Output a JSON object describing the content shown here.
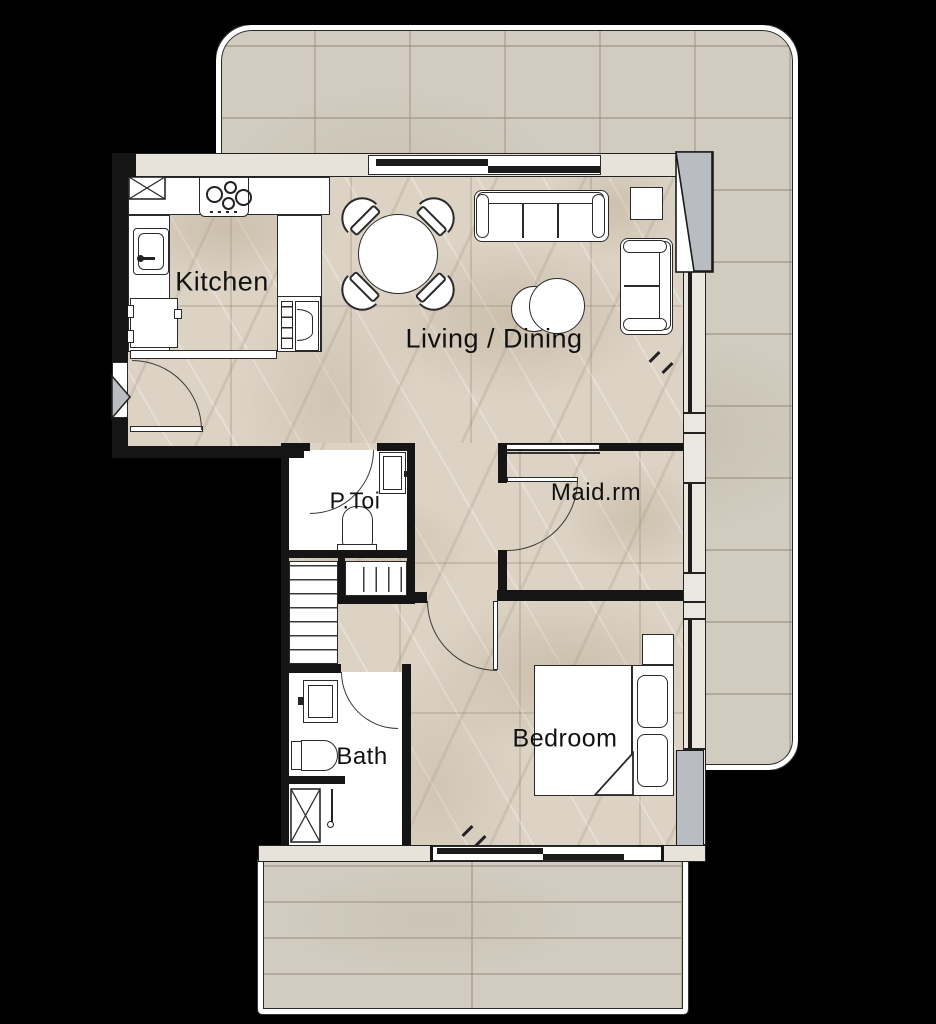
{
  "meta": {
    "type": "apartment-floor-plan"
  },
  "colors": {
    "background": "#000000",
    "terrace_tile": "#d2ccc0",
    "marble_floor": "#dcd3c5",
    "wall": "#151515",
    "wall_face": "#e7e3db",
    "fixture_white": "#ffffff",
    "outline": "#2a2a2a",
    "glass": "#1b1b1b",
    "shadow_gray": "#b9bdc2"
  },
  "rooms": {
    "kitchen": {
      "label": "Kitchen"
    },
    "living_dining": {
      "label": "Living / Dining"
    },
    "p_toi": {
      "label": "P.Toi"
    },
    "maid_room": {
      "label": "Maid.rm"
    },
    "bath": {
      "label": "Bath"
    },
    "bedroom": {
      "label": "Bedroom"
    }
  },
  "furniture_icons": [
    "gas-hob-icon",
    "kitchen-sink-icon",
    "refrigerator-icon",
    "washing-machine-icon",
    "oven-icon",
    "round-dining-table-icon",
    "dining-chair-icon",
    "sofa-icon",
    "side-table-icon",
    "armchair-icon",
    "coffee-table-icon",
    "toilet-icon",
    "wash-basin-icon",
    "shelf-closet-icon",
    "rail-closet-icon",
    "shower-tray-icon",
    "double-bed-icon",
    "pillow-icon",
    "nightstand-icon",
    "door-swing-icon",
    "window-icon",
    "entry-arrow-icon"
  ]
}
